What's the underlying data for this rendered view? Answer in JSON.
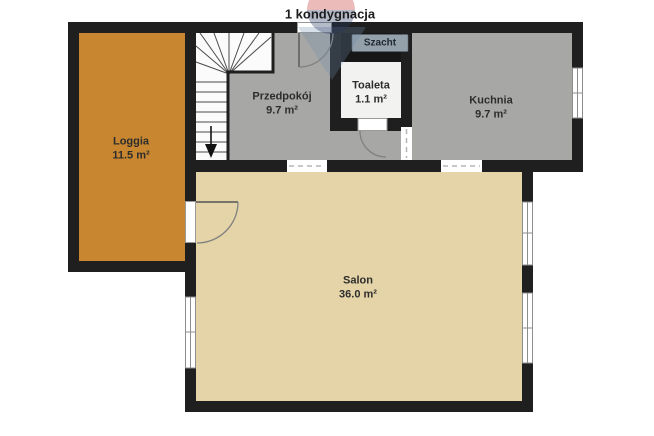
{
  "title": "1 kondygnacja",
  "floor_plan": {
    "rooms": [
      {
        "name": "Loggia",
        "area": "11.5 m²"
      },
      {
        "name": "Przedpokój",
        "area": "9.7 m²"
      },
      {
        "name": "Toaleta",
        "area": "1.1 m²"
      },
      {
        "name": "Kuchnia",
        "area": "9.7 m²"
      },
      {
        "name": "Salon",
        "area": "36.0 m²"
      }
    ],
    "shaft_label": "Szacht",
    "colors": {
      "wall": "#1f1f1f",
      "loggia": "#c7862f",
      "salon": "#e5d4a7",
      "gray_room": "#a7a7a5",
      "toaleta": "#f2f2f0",
      "szacht": "#171717",
      "szacht_chip": "#94a0aa",
      "watermark_red": "#c23b36",
      "watermark_navy": "#2b3a63",
      "watermark_blue": "#6e8cab"
    }
  }
}
